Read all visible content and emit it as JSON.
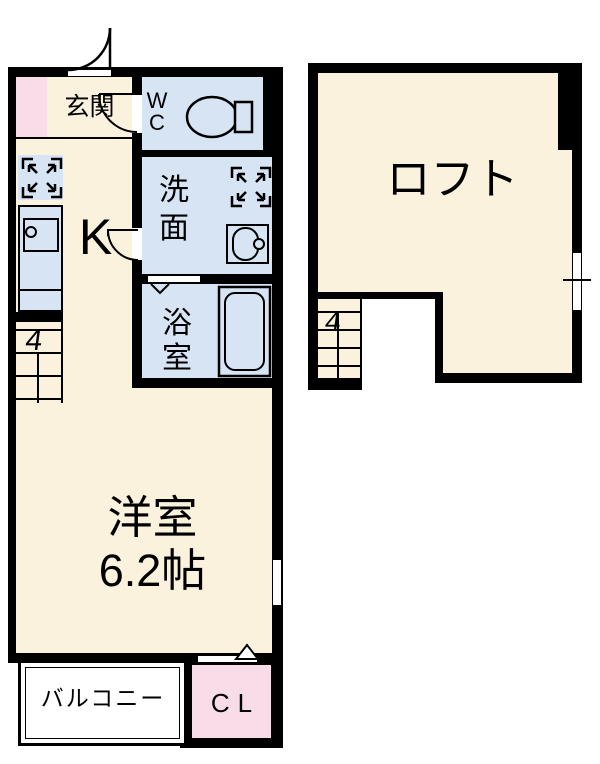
{
  "plan_type": "apartment-floor-plan",
  "colors": {
    "wall": "#000000",
    "room_cream": "#FBF2DE",
    "wet_area_blue": "#D6E4F4",
    "closet_pink": "#F8DCE7",
    "background": "#FFFFFF"
  },
  "first_floor": {
    "rooms": {
      "entrance": {
        "label": "玄関"
      },
      "toilet": {
        "label": "WC"
      },
      "washroom": {
        "label": "洗面"
      },
      "kitchen": {
        "label": "K"
      },
      "bathroom": {
        "label": "浴室"
      },
      "main_room": {
        "label": "洋室",
        "size": "6.2帖"
      },
      "balcony": {
        "label": "バルコニー"
      },
      "closet": {
        "label": "CL"
      }
    },
    "stairs": {
      "label": "4"
    }
  },
  "loft": {
    "label": "ロフト",
    "stairs": {
      "label": "4"
    }
  },
  "icons": {
    "toilet": "toilet-icon",
    "washbasin": "washbasin-icon",
    "bathtub": "bathtub-icon",
    "kitchen_sink": "sink-icon",
    "appliance_space": "expand-arrows-icon",
    "entrance_door": "door-swing-arc-icon",
    "window": "window-slit-icon"
  }
}
